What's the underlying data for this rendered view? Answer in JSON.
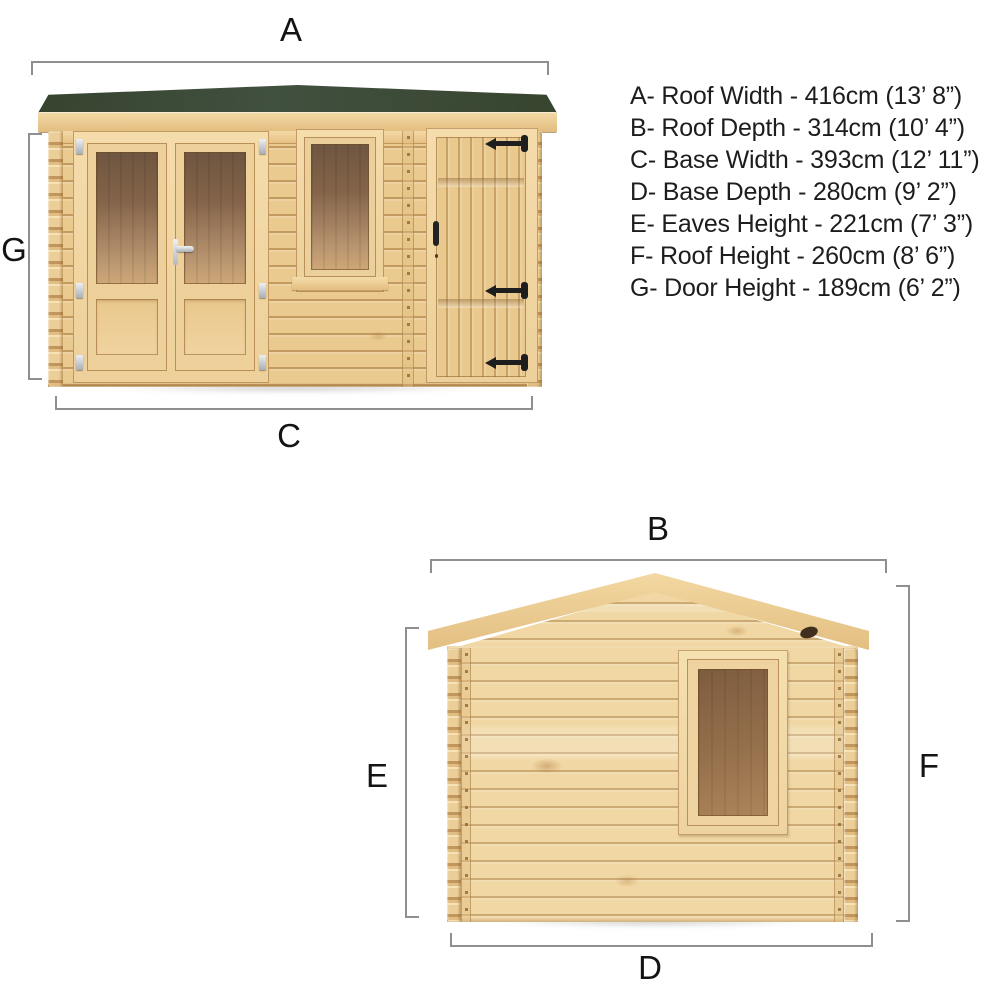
{
  "title": "Log cabin dimension diagram",
  "front_view": {
    "name": "front elevation",
    "dim_labels": {
      "a": "A",
      "c": "C",
      "g": "G"
    }
  },
  "side_view": {
    "name": "side elevation",
    "dim_labels": {
      "b": "B",
      "d": "D",
      "e": "E",
      "f": "F"
    }
  },
  "legend": {
    "items": [
      "A- Roof Width - 416cm (13’ 8”)",
      "B- Roof Depth - 314cm (10’ 4”)",
      "C- Base Width - 393cm (12’ 11”)",
      "D- Base Depth - 280cm (9’ 2”)",
      "E- Eaves Height - 221cm (7’ 3”)",
      "F- Roof Height - 260cm (8’ 6”)",
      "G- Door Height - 189cm (6’ 2”)"
    ]
  },
  "dimensions_cm": {
    "roof_width": 416,
    "roof_depth": 314,
    "base_width": 393,
    "base_depth": 280,
    "eaves_height": 221,
    "roof_height": 260,
    "door_height": 189
  },
  "colors": {
    "roof_felt_green": "#3a4836",
    "wood_light": "#f0d7a3",
    "wood_mid": "#ebca8f",
    "wood_seam": "#926028",
    "glass_tint_dark": "#6f5640",
    "glass_tint_light": "#cfa877",
    "hinge_black": "#1e1e1e",
    "hardware_silver": "#c9ced4",
    "dimension_line": "#8f8f8f",
    "text": "#1d1d1d",
    "background": "#ffffff"
  }
}
